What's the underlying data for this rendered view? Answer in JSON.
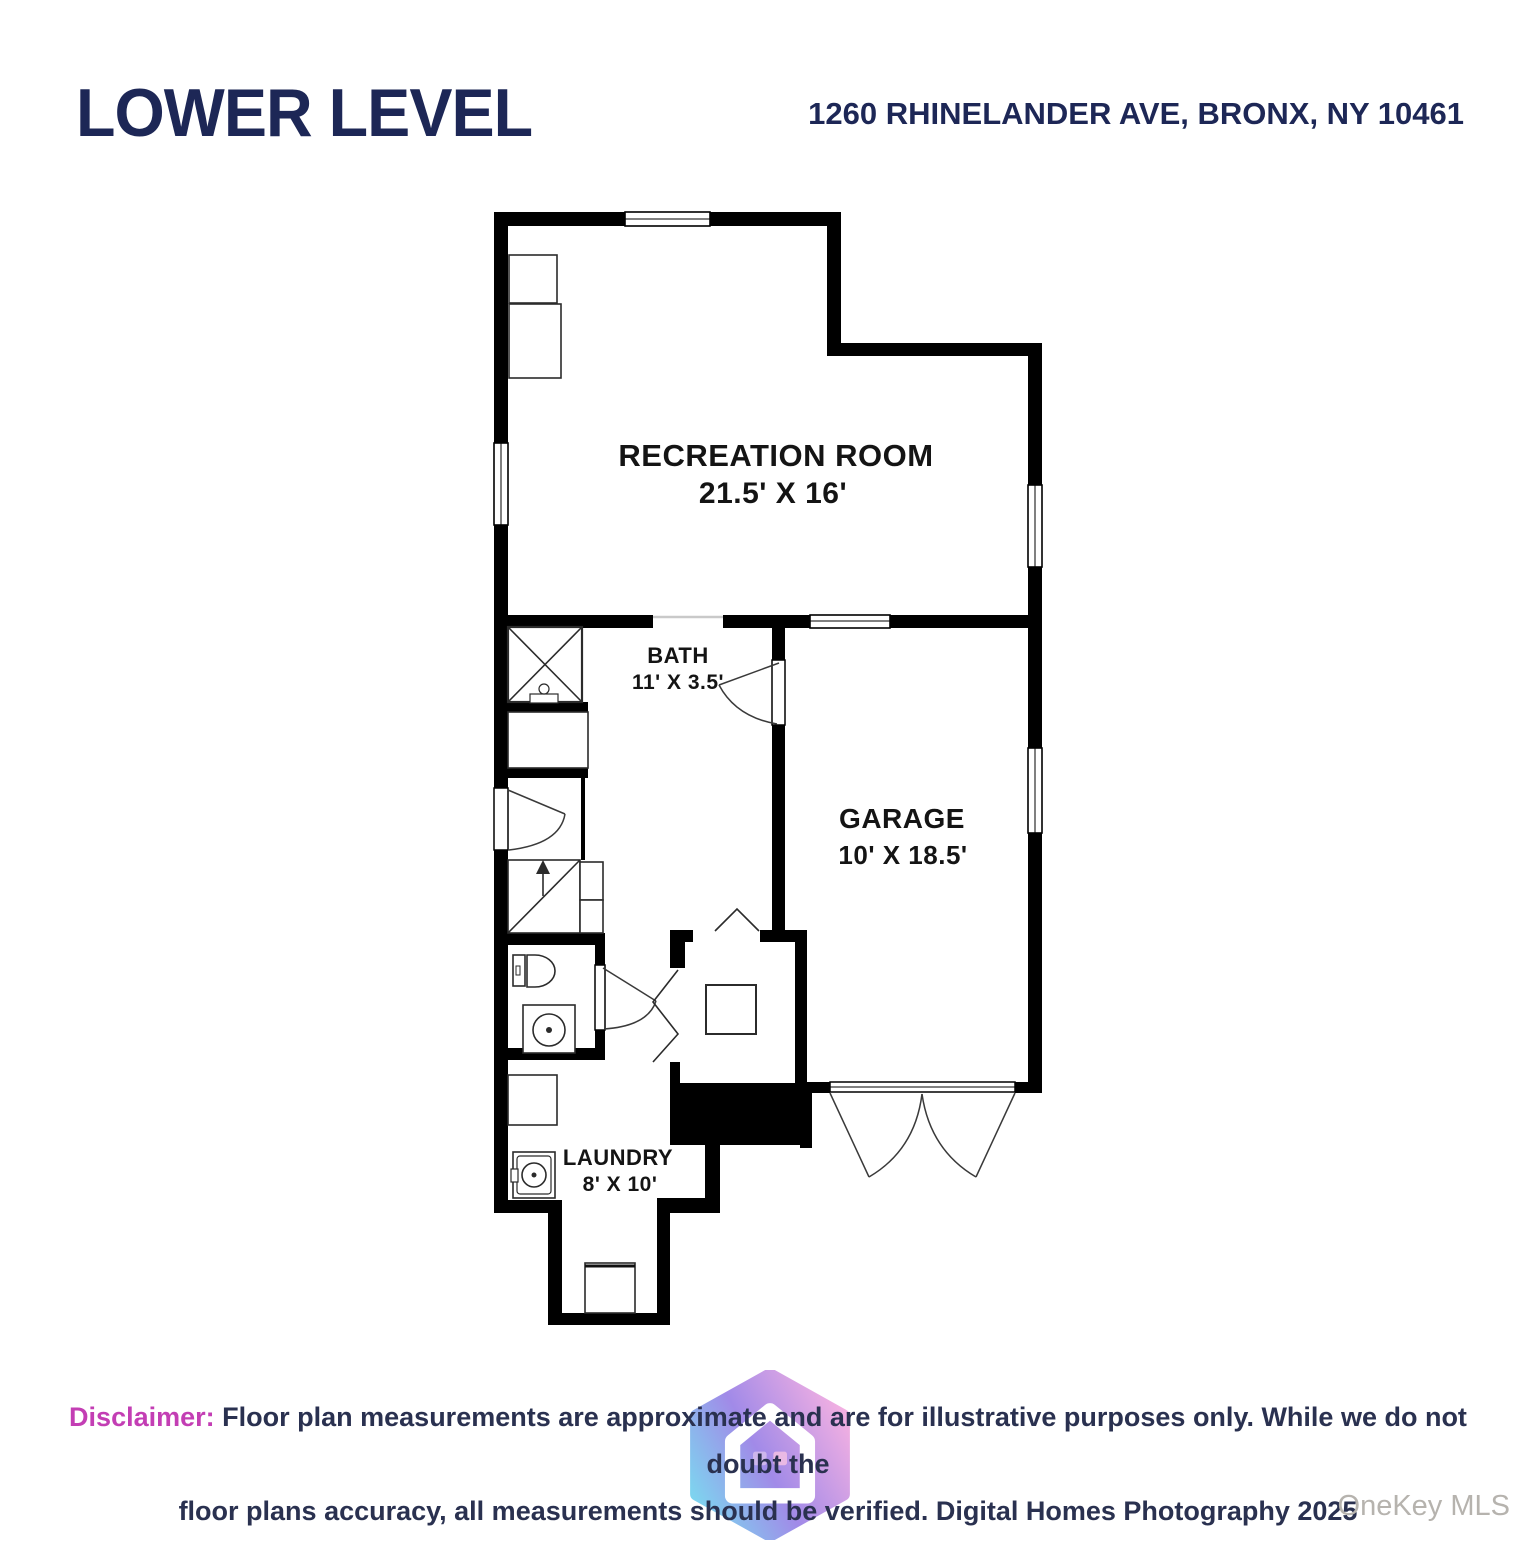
{
  "header": {
    "title": "LOWER LEVEL",
    "address": "1260 RHINELANDER AVE, BRONX, NY 10461"
  },
  "rooms": {
    "recreation": {
      "name": "RECREATION ROOM",
      "dims": "21.5' X 16'"
    },
    "bath": {
      "name": "BATH",
      "dims": "11' X 3.5'"
    },
    "garage": {
      "name": "GARAGE",
      "dims": "10' X 18.5'"
    },
    "laundry": {
      "name": "LAUNDRY",
      "dims": "8' X 10'"
    }
  },
  "icons": {
    "stairs": "up-arrow-icon",
    "logo": "gradient-hexagon-house-icon"
  },
  "disclaimer": {
    "label": "Disclaimer:",
    "line1": "Floor plan measurements are approximate and are for illustrative purposes only. While we do not doubt the",
    "line2": "floor plans accuracy, all measurements should be verified. Digital Homes Photography 2025"
  },
  "watermark": {
    "mls": "OneKey MLS"
  },
  "colors": {
    "brand_navy": "#1d2756",
    "accent_pink": "#c33eb4",
    "watermark_gray": "#b6b3ae",
    "wall_black": "#000000"
  }
}
